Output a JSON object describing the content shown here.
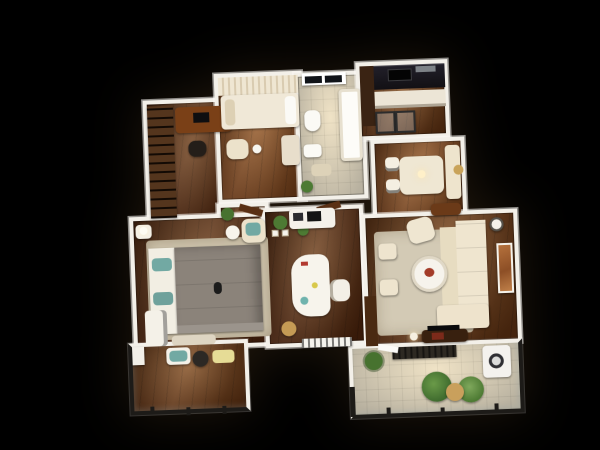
{
  "scene": {
    "description": "Photoreal 3D top-down render of a three-room apartment floor plan on a black background",
    "background_color": "#000000",
    "wall_color": "#f3f0e9",
    "palette": {
      "wood_floor": "#76401a",
      "wood_floor_dark": "#58290e",
      "accent_teal": "#72a9a3",
      "rug_beige": "#cfc5ae",
      "sofa_cream": "#efe5cf",
      "duvet_gray": "#8b837a",
      "kitchen_counter_black": "#191619",
      "artwork_orange": "#a96434",
      "plant_green": "#4d7a33",
      "railing_dark": "#1d1b18",
      "tile_cream": "#ece3cd"
    },
    "rooms": [
      {
        "id": "closet-study",
        "name": "Closet / Study",
        "floor": "dark wood",
        "furniture": [
          "wardrobe shelving",
          "wood desk",
          "black laptop",
          "chair"
        ]
      },
      {
        "id": "second-bedroom",
        "name": "Second Bedroom",
        "floor": "wood",
        "furniture": [
          "bed with cream curtain wall",
          "white pillows",
          "armchair",
          "floor lamp",
          "dresser"
        ]
      },
      {
        "id": "bathroom",
        "name": "Bathroom",
        "floor": "cream tile",
        "furniture": [
          "window with dark panes and blind",
          "bathtub",
          "toilet",
          "sink",
          "bath mat",
          "potted plant"
        ]
      },
      {
        "id": "kitchen",
        "name": "Kitchen",
        "floor": "wood",
        "furniture": [
          "black counter with cooktop",
          "steel hood",
          "white cabinet row",
          "glass partition",
          "tall dark cabinet"
        ]
      },
      {
        "id": "dining-area",
        "name": "Dining Area",
        "floor": "wood",
        "furniture": [
          "cream table",
          "two chairs",
          "window bench",
          "wood sideboard",
          "round gold mirror",
          "pendant light"
        ]
      },
      {
        "id": "hallway",
        "name": "Hallway",
        "floor": "wood",
        "furniture": [
          "two open wood doors",
          "potted plants",
          "small wall frames"
        ]
      },
      {
        "id": "master-bedroom",
        "name": "Master Bedroom",
        "floor": "dark wood",
        "furniture": [
          "double bed with gray duvet",
          "white pillows",
          "teal accent pillows",
          "beige area rug",
          "armchair with teal cushion",
          "round side table",
          "nightstand with lamp",
          "white dresser",
          "foot bench"
        ]
      },
      {
        "id": "home-office",
        "name": "Home Office",
        "floor": "dark wood",
        "furniture": [
          "curved white desk",
          "white desk chair",
          "shelf with black printer",
          "potted plant",
          "rattan basket",
          "white radiator bench"
        ]
      },
      {
        "id": "living-room",
        "name": "Living Room",
        "floor": "wood",
        "furniture": [
          "L-shaped cream sofa",
          "cream armchair",
          "round white coffee table",
          "two poufs",
          "beige rug",
          "orange wall artwork",
          "dark TV cabinet with TV",
          "side table",
          "floor lamp",
          "wood accent panel"
        ]
      },
      {
        "id": "bedroom-balcony",
        "name": "Bedroom Balcony",
        "floor": "wood",
        "furniture": [
          "white bench with teal cushion",
          "dark round table",
          "yellow tray",
          "white planter",
          "dark railing with glass"
        ]
      },
      {
        "id": "living-balcony",
        "name": "Living Balcony",
        "floor": "cream tile",
        "furniture": [
          "dark floor grate",
          "three potted plants",
          "woven stool",
          "washing machine",
          "white entry door",
          "dark railing with glass"
        ]
      }
    ]
  }
}
